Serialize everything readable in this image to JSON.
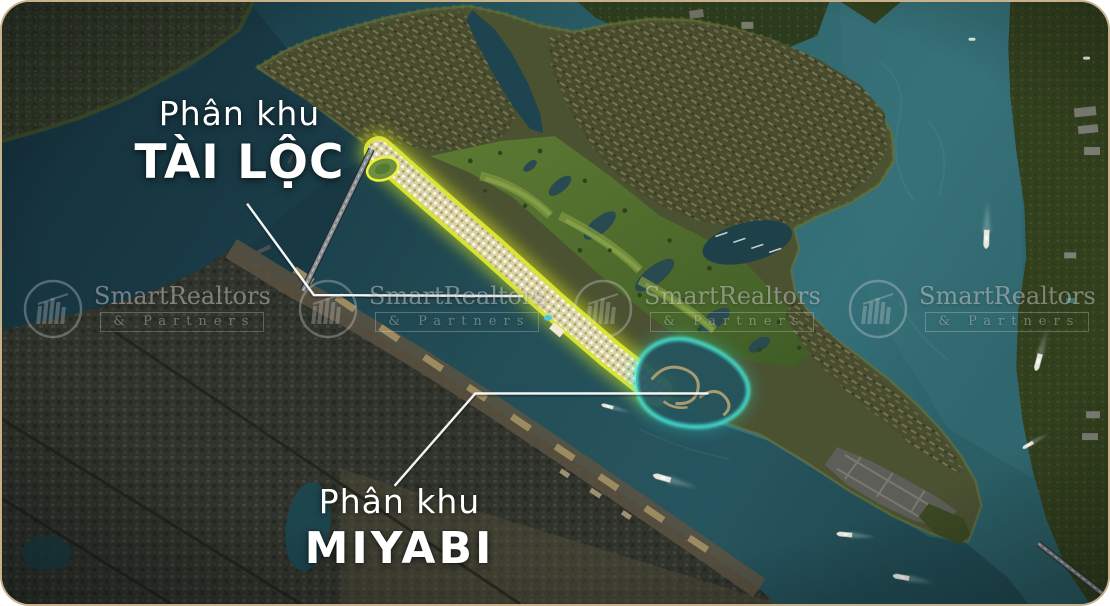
{
  "zones": {
    "tai_loc": {
      "prefix": "Phân khu",
      "name": "TÀI LỘC",
      "highlight_color": "#e9f233"
    },
    "miyabi": {
      "prefix": "Phân khu",
      "name": "MIYABI",
      "highlight_color": "#38e5d4"
    }
  },
  "watermark": {
    "brand": "SmartRealtors",
    "suffix": "& Partners"
  },
  "map_colors": {
    "water": "#2b5f66",
    "frame_border": "#c9b289"
  }
}
